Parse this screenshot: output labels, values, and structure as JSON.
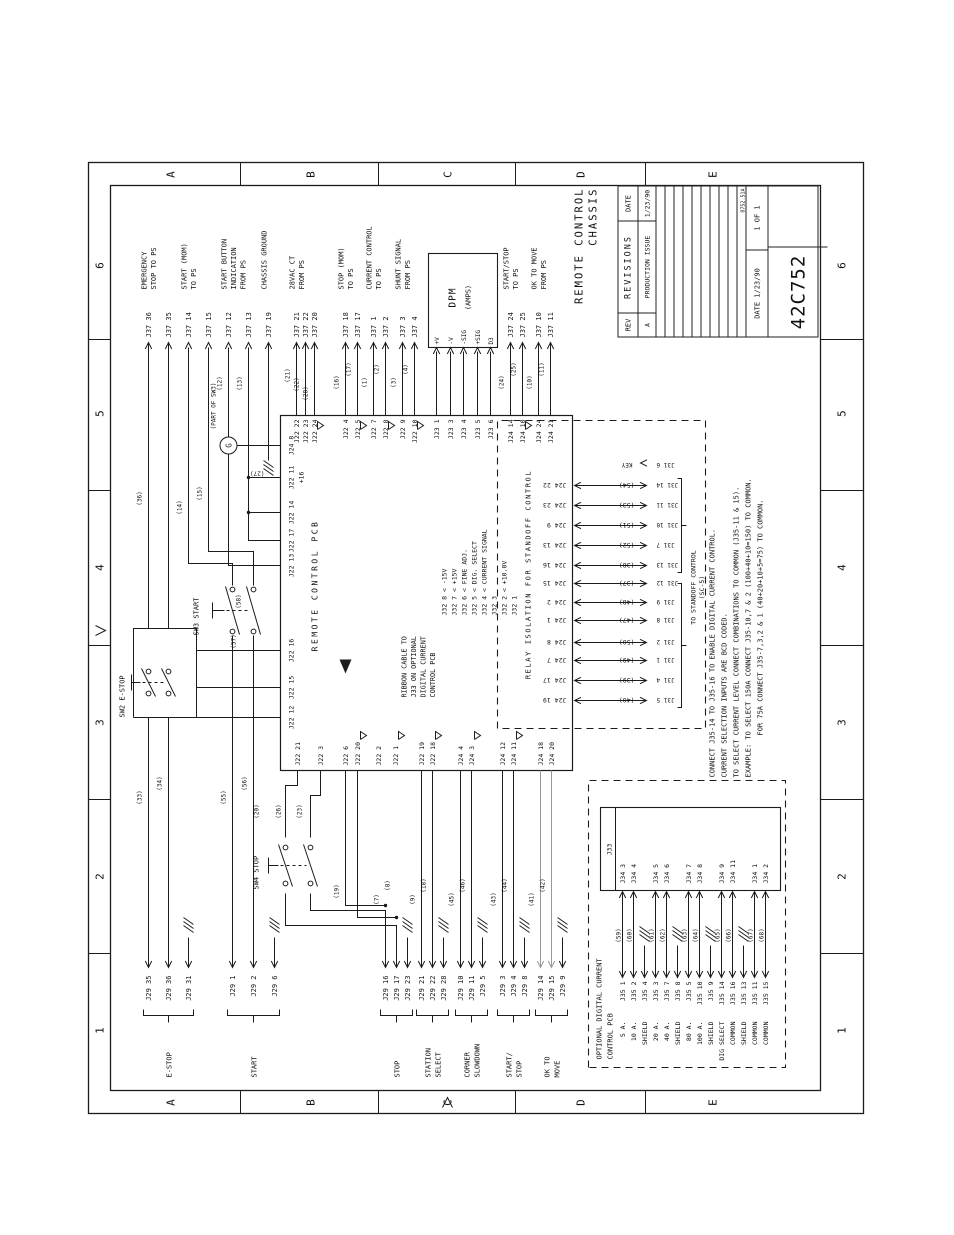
{
  "titleblock": {
    "revisions": {
      "header": "REVISIONS",
      "rev_col": "REV",
      "date_col": "DATE",
      "rows": [
        {
          "rev": "A",
          "desc": "PRODUCTION ISSUE",
          "date": "1/23/90"
        }
      ]
    },
    "date_label": "DATE",
    "date": "1/23/90",
    "sheet": "1 OF 1",
    "number": "42C752",
    "doc_code": "8752.51A",
    "title_lines": [
      "REMOTE CONTROL",
      "CHASSIS"
    ]
  },
  "zones": {
    "letters": [
      "A",
      "B",
      "C",
      "D",
      "E"
    ],
    "numbers": [
      "6",
      "5",
      "4",
      "3",
      "2",
      "1"
    ]
  },
  "ps_groups": [
    {
      "desc": [
        "EMERGENCY",
        "STOP TO PS"
      ],
      "pins": [
        {
          "id": "J37 36",
          "y": 148,
          "from": 607
        },
        {
          "id": "J37 35",
          "y": 168,
          "from": 607
        }
      ]
    },
    {
      "desc": [
        "START (MOM)",
        "TO PS"
      ],
      "pins": [
        {
          "id": "J37 14",
          "y": 188,
          "from": null
        },
        {
          "id": "J37 15",
          "y": 208,
          "from": null
        }
      ]
    },
    {
      "desc": [
        "START BUTTON",
        "INDICATION",
        "FROM PS"
      ],
      "pins": [
        {
          "id": "J37 12",
          "y": 228,
          "from": null
        },
        {
          "id": "J37 13",
          "y": 248,
          "from": null
        }
      ]
    },
    {
      "desc": [
        "CHASSIS GROUND"
      ],
      "pins": [
        {
          "id": "J37 19",
          "y": 268,
          "from": 775
        }
      ]
    },
    {
      "desc": [
        "28VAC CT",
        "FROM PS"
      ],
      "pins": [
        {
          "id": "J37 21",
          "y": 296
        },
        {
          "id": "J37 22",
          "y": 305
        },
        {
          "id": "J37 20",
          "y": 314
        }
      ]
    },
    {
      "desc": [
        "STOP (MOM)",
        "TO PS"
      ],
      "pins": [
        {
          "id": "J37 18",
          "y": 345
        },
        {
          "id": "J37 17",
          "y": 357
        }
      ]
    },
    {
      "desc": [
        "CURRENT CONTROL",
        "TO PS"
      ],
      "pins": [
        {
          "id": "J37 1",
          "y": 373
        },
        {
          "id": "J37 2",
          "y": 385
        }
      ]
    },
    {
      "desc": [
        "SHUNT SIGNAL",
        "FROM PS"
      ],
      "pins": [
        {
          "id": "J37 3",
          "y": 402
        },
        {
          "id": "J37 4",
          "y": 414
        }
      ]
    },
    {
      "desc": [
        "START/STOP",
        "TO PS"
      ],
      "pins": [
        {
          "id": "J37 24",
          "y": 510
        },
        {
          "id": "J37 25",
          "y": 522
        }
      ]
    },
    {
      "desc": [
        "OK TO MOVE",
        "FROM PS"
      ],
      "pins": [
        {
          "id": "J37 10",
          "y": 538
        },
        {
          "id": "J37 11",
          "y": 550
        }
      ]
    }
  ],
  "field_groups": [
    {
      "label": [
        "E-STOP"
      ],
      "pins": [
        {
          "id": "J29 35",
          "y": 148,
          "to": 518
        },
        {
          "id": "J29 36",
          "y": 168,
          "to": 518
        },
        {
          "id": "J29 31",
          "y": 188,
          "gnd": true
        }
      ]
    },
    {
      "label": [
        "START"
      ],
      "pins": [
        {
          "id": "J29 1",
          "y": 232,
          "to": 600
        },
        {
          "id": "J29 2",
          "y": 253,
          "to": 600
        },
        {
          "id": "J29 6",
          "y": 274,
          "gnd": true
        }
      ]
    },
    {
      "label": [
        "STOP"
      ],
      "pins": [
        {
          "id": "J29 16",
          "y": 385,
          "to": null
        },
        {
          "id": "J29 17",
          "y": 396,
          "to": null
        },
        {
          "id": "J29 23",
          "y": 407,
          "gnd": true
        }
      ]
    },
    {
      "label": [
        "STATION",
        "SELECT"
      ],
      "pins": [
        {
          "id": "J29 21",
          "y": 421
        },
        {
          "id": "J29 22",
          "y": 432
        },
        {
          "id": "J29 28",
          "y": 443,
          "gnd": true
        }
      ]
    },
    {
      "label": [
        "CORNER",
        "SLOWDOWN"
      ],
      "pins": [
        {
          "id": "J29 10",
          "y": 460
        },
        {
          "id": "J29 11",
          "y": 471
        },
        {
          "id": "J29 5",
          "y": 482,
          "gnd": true
        }
      ]
    },
    {
      "label": [
        "START/",
        "STOP"
      ],
      "pins": [
        {
          "id": "J29 3",
          "y": 502
        },
        {
          "id": "J29 4",
          "y": 513
        },
        {
          "id": "J29 8",
          "y": 524,
          "gnd": true
        }
      ]
    },
    {
      "label": [
        "OK TO",
        "MOVE"
      ],
      "pins": [
        {
          "id": "J29 14",
          "y": 540,
          "grey": true
        },
        {
          "id": "J29 15",
          "y": 551,
          "grey": true
        },
        {
          "id": "J29 9",
          "y": 562,
          "gnd": true
        }
      ]
    }
  ],
  "pcb": {
    "label": "REMOTE CONTROL PCB",
    "right_pins": [
      {
        "id": "J22 22",
        "y": 296
      },
      {
        "id": "J22 23",
        "y": 305
      },
      {
        "id": "J22 24",
        "y": 314,
        "tri": true
      },
      {
        "id": "J22 4",
        "y": 345
      },
      {
        "id": "J22 5",
        "y": 357,
        "tri": true
      },
      {
        "id": "J22 7",
        "y": 373
      },
      {
        "id": "J22 8",
        "y": 385,
        "tri": true
      },
      {
        "id": "J22 9",
        "y": 402
      },
      {
        "id": "J22 10",
        "y": 414,
        "tri": true
      },
      {
        "id": "J23 1",
        "y": 436
      },
      {
        "id": "J23 3",
        "y": 450
      },
      {
        "id": "J23 4",
        "y": 463
      },
      {
        "id": "J23 5",
        "y": 477
      },
      {
        "id": "J23 6",
        "y": 490
      },
      {
        "id": "J24 14",
        "y": 510
      },
      {
        "id": "J24 10",
        "y": 522,
        "tri": true
      },
      {
        "id": "J24 24",
        "y": 538
      },
      {
        "id": "J24 21",
        "y": 550
      }
    ],
    "left_pins": [
      {
        "id": "J22 21",
        "y": 297
      },
      {
        "id": "J22 3",
        "y": 320
      },
      {
        "id": "J22 6",
        "y": 345
      },
      {
        "id": "J22 20",
        "y": 357,
        "tri": true
      },
      {
        "id": "J22 2",
        "y": 378
      },
      {
        "id": "J22 1",
        "y": 395,
        "tri": true
      },
      {
        "id": "J22 19",
        "y": 421
      },
      {
        "id": "J22 18",
        "y": 432,
        "tri": true
      },
      {
        "id": "J24 4",
        "y": 460
      },
      {
        "id": "J24 3",
        "y": 471,
        "tri": true
      },
      {
        "id": "J24 12",
        "y": 502
      },
      {
        "id": "J24 11",
        "y": 513,
        "tri": true
      },
      {
        "id": "J24 18",
        "y": 540,
        "grey": true
      },
      {
        "id": "J24 20",
        "y": 551,
        "grey": true
      }
    ],
    "top_pins": [
      {
        "id": "J22 12",
        "x": 518
      },
      {
        "id": "J22 15",
        "x": 548
      },
      {
        "id": "J22 16",
        "x": 585
      },
      {
        "id": "J22 13",
        "x": 670
      },
      {
        "id": "J22 17",
        "x": 695
      },
      {
        "id": "J22 14",
        "x": 723
      },
      {
        "id": "J22 11",
        "x": 758,
        "note": "+16"
      },
      {
        "id": "J24 8",
        "x": 790
      }
    ],
    "j32_rows": [
      "J32 8 < -15V",
      "J32 7 < +15V",
      "J32 6 < FINE ADJ.",
      "J32 5 < DIG. SELECT",
      "J32 4 < CURRENT SIGNAL",
      "J32 3",
      "J32 2 < +10.0V",
      "J32 1"
    ],
    "ribbon_note": [
      "RIBBON CABLE TO",
      "J33 ON OPTIONAL",
      "DIGITAL CURRENT",
      "CONTROL PCB"
    ]
  },
  "relay": {
    "label": "RELAY ISOLATION FOR STANDOFF CONTROL",
    "to_lines": [
      "TO STANDOFF CONTROL",
      "(SC-5)"
    ],
    "key": {
      "pin": "J31 6",
      "label": "KEY"
    },
    "rungs": [
      {
        "x": 750,
        "j24": "J24 22",
        "w": "(54)",
        "j31": "J31 14"
      },
      {
        "x": 730,
        "j24": "J24 23",
        "w": "(53)",
        "j31": "J31 11"
      },
      {
        "x": 710,
        "j24": "J24 9",
        "w": "(51)",
        "j31": "J31 10"
      },
      {
        "x": 690,
        "j24": "J24 13",
        "w": "(52)",
        "j31": "J31 7"
      },
      {
        "x": 670,
        "j24": "J24 16",
        "w": "(38)",
        "j31": "J31 13"
      },
      {
        "x": 652,
        "j24": "J24 15",
        "w": "(37)",
        "j31": "J31 12"
      },
      {
        "x": 633,
        "j24": "J24 2",
        "w": "(48)",
        "j31": "J31 9"
      },
      {
        "x": 615,
        "j24": "J24 1",
        "w": "(47)",
        "j31": "J31 8"
      },
      {
        "x": 593,
        "j24": "J24 8",
        "w": "(50)",
        "j31": "J31 2"
      },
      {
        "x": 575,
        "j24": "J24 7",
        "w": "(49)",
        "j31": "J31 1"
      },
      {
        "x": 555,
        "j24": "J24 17",
        "w": "(39)",
        "j31": "J31 4"
      },
      {
        "x": 535,
        "j24": "J24 19",
        "w": "(40)",
        "j31": "J31 5"
      }
    ]
  },
  "optional": {
    "label": [
      "OPTIONAL DIGITAL CURRENT",
      "CONTROL PCB"
    ],
    "j33": "J33",
    "rows": [
      {
        "amp": "5 A.",
        "j35": "J35 1",
        "w": "(59)",
        "j34": "J34 3"
      },
      {
        "amp": "10 A.",
        "j35": "J35 2",
        "w": "(60)",
        "j34": "J34 4"
      },
      {
        "amp": "SHIELD",
        "j35": "J35 4",
        "gnd": true
      },
      {
        "amp": "20 A.",
        "j35": "J35 3",
        "w": "(61)",
        "j34": "J34 5"
      },
      {
        "amp": "40 A.",
        "j35": "J35 7",
        "w": "(62)",
        "j34": "J34 6"
      },
      {
        "amp": "SHIELD",
        "j35": "J35 8",
        "gnd": true
      },
      {
        "amp": "80 A.",
        "j35": "J35 5",
        "w": "(63)",
        "j34": "J34 7"
      },
      {
        "amp": "100 A.",
        "j35": "J35 10",
        "w": "(64)",
        "j34": "J34 8"
      },
      {
        "amp": "SHIELD",
        "j35": "J35 9",
        "gnd": true
      },
      {
        "amp": "DIG SELECT",
        "j35": "J35 14",
        "w": "(65)",
        "j34": "J34 9"
      },
      {
        "amp": "COMMON",
        "j35": "J35 16",
        "w": "(66)",
        "j34": "J34 11"
      },
      {
        "amp": "SHIELD",
        "j35": "J35 13",
        "gnd": true
      },
      {
        "amp": "COMMON",
        "j35": "J35 11",
        "w": "(67)",
        "j34": "J34 1"
      },
      {
        "amp": "COMMON",
        "j35": "J35 15",
        "w": "(68)",
        "j34": "J34 2"
      }
    ]
  },
  "dpm": {
    "title": "DPM",
    "sub": "(AMPS)",
    "pins": [
      {
        "l": "+V",
        "y": 436
      },
      {
        "l": "-V",
        "y": 450
      },
      {
        "l": "-SIG",
        "y": 463
      },
      {
        "l": "+SIG",
        "y": 477
      },
      {
        "l": "D3",
        "y": 490
      }
    ]
  },
  "switches": {
    "sw2": "SW2 E-STOP",
    "sw3": "SW3 START",
    "sw4": "SW4 STOP",
    "lamp": "G",
    "lamp_note": "(PART OF SW3)"
  },
  "notes": [
    "CONNECT J35-14 TO J35-16 TO ENABLE DIGITAL CURRENT CONTROL.",
    "CURRENT SELECTION INPUTS ARE BCD CODED.",
    "TO SELECT CURRENT LEVEL CONNECT COMBINATIONS TO COMMON (J35-11 & 15).",
    "EXAMPLE: TO SELECT 150A CONNECT J35-10,7 & 2 (100+40+10=150) TO COMMON.",
    "FOR 75A CONNECT J35-7,3,2 & 1 (40+20+10+5=75) TO COMMON."
  ],
  "wire_labels": [
    {
      "t": "(33)",
      "x": 438,
      "y": 144
    },
    {
      "t": "(34)",
      "x": 452,
      "y": 164
    },
    {
      "t": "(36)",
      "x": 737,
      "y": 144
    },
    {
      "t": "(55)",
      "x": 438,
      "y": 228
    },
    {
      "t": "(56)",
      "x": 452,
      "y": 249
    },
    {
      "t": "(57)",
      "x": 594,
      "y": 238
    },
    {
      "t": "(58)",
      "x": 634,
      "y": 243
    },
    {
      "t": "(14)",
      "x": 728,
      "y": 184
    },
    {
      "t": "(15)",
      "x": 742,
      "y": 204
    },
    {
      "t": "(12)",
      "x": 852,
      "y": 224
    },
    {
      "t": "(13)",
      "x": 852,
      "y": 244
    },
    {
      "t": "(27)",
      "x": 764,
      "y": 264,
      "v": true
    },
    {
      "t": "(21)",
      "x": 860,
      "y": 292
    },
    {
      "t": "(22)",
      "x": 851,
      "y": 301
    },
    {
      "t": "(28)",
      "x": 842,
      "y": 310
    },
    {
      "t": "(16)",
      "x": 853,
      "y": 341
    },
    {
      "t": "(17)",
      "x": 866,
      "y": 353
    },
    {
      "t": "(1)",
      "x": 853,
      "y": 369
    },
    {
      "t": "(2)",
      "x": 866,
      "y": 381
    },
    {
      "t": "(3)",
      "x": 853,
      "y": 398
    },
    {
      "t": "(4)",
      "x": 866,
      "y": 410
    },
    {
      "t": "(24)",
      "x": 853,
      "y": 506
    },
    {
      "t": "(25)",
      "x": 866,
      "y": 518
    },
    {
      "t": "(10)",
      "x": 853,
      "y": 534
    },
    {
      "t": "(11)",
      "x": 866,
      "y": 546
    },
    {
      "t": "(20)",
      "x": 424,
      "y": 261
    },
    {
      "t": "(26)",
      "x": 424,
      "y": 283
    },
    {
      "t": "(23)",
      "x": 424,
      "y": 304
    },
    {
      "t": "(19)",
      "x": 344,
      "y": 341
    },
    {
      "t": "(7)",
      "x": 336,
      "y": 381
    },
    {
      "t": "(8)",
      "x": 350,
      "y": 392
    },
    {
      "t": "(9)",
      "x": 336,
      "y": 417
    },
    {
      "t": "(18)",
      "x": 350,
      "y": 428
    },
    {
      "t": "(45)",
      "x": 336,
      "y": 456
    },
    {
      "t": "(46)",
      "x": 350,
      "y": 467
    },
    {
      "t": "(43)",
      "x": 336,
      "y": 498
    },
    {
      "t": "(44)",
      "x": 350,
      "y": 509
    },
    {
      "t": "(41)",
      "x": 336,
      "y": 536
    },
    {
      "t": "(42)",
      "x": 350,
      "y": 547
    }
  ]
}
